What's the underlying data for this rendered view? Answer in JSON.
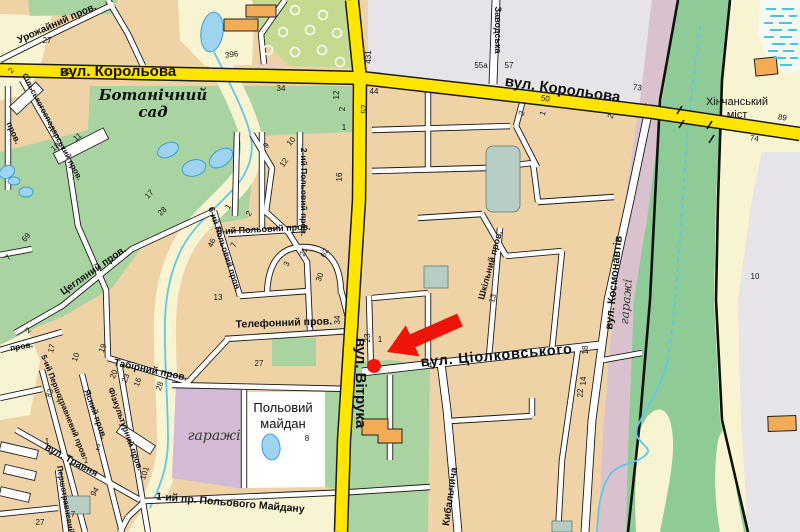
{
  "map": {
    "palette": {
      "main_road_yellow": "#FFE500",
      "road_casing_black": "#1B1B1B",
      "minor_road_white": "#FFFFFF",
      "city_block_tan": "#EFD3A6",
      "field_cream": "#F8F4D2",
      "park_green": "#A9D3A0",
      "orchard_green": "#C3DA90",
      "valley_green": "#8FCB96",
      "railway_band_mauve": "#D9C2CE",
      "garage_block_mauve": "#D5BAD6",
      "urban_grey": "#E6E4E9",
      "water_blue": "#9FD4F0",
      "stream_blue": "#5FC8E6",
      "reservoir_teal": "#B5CDC4",
      "building_orange": "#F2AC55",
      "marker_red": "#EE1408"
    },
    "marker": {
      "type": "arrow-and-dot",
      "color": "#EE1408"
    },
    "street_labels": [
      {
        "t": "вул. Корольова",
        "x": 118,
        "y": 76,
        "r": 0,
        "c": "s-big",
        "n": "street-korolova-west"
      },
      {
        "t": "вул. Корольова",
        "x": 562,
        "y": 94,
        "r": 8,
        "c": "s-big",
        "n": "street-korolova-east"
      },
      {
        "t": "вул. Вітрука",
        "x": 356,
        "y": 383,
        "r": 90,
        "c": "s-big",
        "n": "street-vitruka"
      },
      {
        "t": "вул. Ціолковського",
        "x": 497,
        "y": 360,
        "r": -5,
        "c": "s-ciol",
        "n": "street-tsiolkovskogo"
      },
      {
        "t": "вул. Космонавтів",
        "x": 617,
        "y": 283,
        "r": -84,
        "c": "s-med",
        "n": "street-kosmonavtiv"
      },
      {
        "t": "Ботанічний",
        "x": 153,
        "y": 100,
        "r": 0,
        "c": "s-serif",
        "n": "area-botanical-garden-line1"
      },
      {
        "t": "сад",
        "x": 153,
        "y": 117,
        "r": 0,
        "c": "s-serif",
        "n": "area-botanical-garden-line2"
      },
      {
        "t": "Хінчанський",
        "x": 737,
        "y": 105,
        "r": 0,
        "c": "s-plain11",
        "n": "bridge-khinchanskyi-line1"
      },
      {
        "t": "міст",
        "x": 737,
        "y": 118,
        "r": 0,
        "c": "s-plain11",
        "n": "bridge-khinchanskyi-line2"
      },
      {
        "t": "гаражі",
        "x": 630,
        "y": 302,
        "r": -85,
        "c": "s-serifg",
        "n": "area-garages-east"
      },
      {
        "t": "гаражі",
        "x": 214,
        "y": 440,
        "r": 0,
        "c": "s-serifg14",
        "n": "area-garages-south"
      },
      {
        "t": "Польовий",
        "x": 283,
        "y": 412,
        "r": 0,
        "c": "s-plain",
        "n": "area-polovyi-maidan-line1"
      },
      {
        "t": "майдан",
        "x": 283,
        "y": 428,
        "r": 0,
        "c": "s-plain",
        "n": "area-polovyi-maidan-line2"
      },
      {
        "t": "Урожайний пров.",
        "x": 58,
        "y": 26,
        "r": -24,
        "c": "s-lane",
        "n": "lane-urozhainyi"
      },
      {
        "t": "Сільськогосподарський пров.",
        "x": 50,
        "y": 128,
        "r": 62,
        "c": "s-lane8",
        "n": "lane-silskohospodarskyi"
      },
      {
        "t": "Цегляний пров.",
        "x": 95,
        "y": 273,
        "r": -35,
        "c": "s-lane",
        "n": "lane-tsehlianyi"
      },
      {
        "t": "Телефонний пров.",
        "x": 284,
        "y": 326,
        "r": -2,
        "c": "s-lane105",
        "n": "lane-telefonnyi"
      },
      {
        "t": "Табірний пров.",
        "x": 150,
        "y": 373,
        "r": 12,
        "c": "s-lane",
        "n": "lane-tabirnyi"
      },
      {
        "t": "5-ий Польовий пров.",
        "x": 264,
        "y": 232,
        "r": -3,
        "c": "s-lane9",
        "n": "lane-polovyi-5"
      },
      {
        "t": "2-ий Польовий пров.",
        "x": 301,
        "y": 192,
        "r": 90,
        "c": "s-lane85",
        "n": "lane-polovyi-2"
      },
      {
        "t": "6-ий Польовий пров.",
        "x": 222,
        "y": 250,
        "r": 72,
        "c": "s-lane85",
        "n": "lane-polovyi-6"
      },
      {
        "t": "5-ий Першотравневий пров.",
        "x": 62,
        "y": 408,
        "r": 68,
        "c": "s-lane8",
        "n": "lane-pershotravnevyi-5"
      },
      {
        "t": "Ясний пров.",
        "x": 93,
        "y": 415,
        "r": 70,
        "c": "s-lane85",
        "n": "lane-yasnyi"
      },
      {
        "t": "Фізкультурний пров.",
        "x": 123,
        "y": 430,
        "r": 70,
        "c": "s-lane85",
        "n": "lane-fizkulturnyi"
      },
      {
        "t": "вул. Травня",
        "x": 70,
        "y": 463,
        "r": 28,
        "c": "s-lane",
        "n": "street-travnia"
      },
      {
        "t": "Першотравневий",
        "x": 63,
        "y": 500,
        "r": 80,
        "c": "s-lane8",
        "n": "lane-pershotravnevyi"
      },
      {
        "t": "1-ий пр. Польового Майдану",
        "x": 230,
        "y": 506,
        "r": 5,
        "c": "s-lane105",
        "n": "lane-pr-polovogo-maidanu"
      },
      {
        "t": "Шкільний пров.",
        "x": 493,
        "y": 266,
        "r": -75,
        "c": "s-lane9",
        "n": "lane-shkilnyi"
      },
      {
        "t": "Кибальчича",
        "x": 453,
        "y": 497,
        "r": -82,
        "c": "s-lane",
        "n": "street-kybalchycha"
      },
      {
        "t": "Заводська",
        "x": 495,
        "y": 30,
        "r": 90,
        "c": "s-lane9",
        "n": "street-zavodska"
      },
      {
        "t": "пров.",
        "x": 11,
        "y": 134,
        "r": 65,
        "c": "s-lane85",
        "n": "lane-left-edge"
      },
      {
        "t": "пров.",
        "x": 22,
        "y": 349,
        "r": -10,
        "c": "s-lane85",
        "n": "lane-left-edge-2"
      }
    ],
    "house_numbers": [
      {
        "t": "27",
        "x": 47,
        "y": 43
      },
      {
        "t": "396",
        "x": 232,
        "y": 57,
        "r": -8
      },
      {
        "t": "2",
        "x": 13,
        "y": 72,
        "r": -50
      },
      {
        "t": "32",
        "x": 67,
        "y": 74
      },
      {
        "t": "34",
        "x": 281,
        "y": 91
      },
      {
        "t": "12",
        "x": 339,
        "y": 95,
        "r": -90
      },
      {
        "t": "2",
        "x": 345,
        "y": 109,
        "r": -90
      },
      {
        "t": "1",
        "x": 344,
        "y": 130
      },
      {
        "t": "44",
        "x": 374,
        "y": 94
      },
      {
        "t": "52",
        "x": 367,
        "y": 109,
        "r": -90
      },
      {
        "t": "431",
        "x": 371,
        "y": 57,
        "r": -90
      },
      {
        "t": "55а",
        "x": 481,
        "y": 68
      },
      {
        "t": "57",
        "x": 509,
        "y": 68
      },
      {
        "t": "73",
        "x": 637,
        "y": 90,
        "r": 8
      },
      {
        "t": "50",
        "x": 545,
        "y": 101,
        "r": 8
      },
      {
        "t": "2",
        "x": 524,
        "y": 114,
        "r": -70
      },
      {
        "t": "1",
        "x": 545,
        "y": 114,
        "r": -70
      },
      {
        "t": "2",
        "x": 613,
        "y": 117,
        "r": -70
      },
      {
        "t": "89",
        "x": 782,
        "y": 120,
        "r": 8
      },
      {
        "t": "74",
        "x": 754,
        "y": 141,
        "r": 8
      },
      {
        "t": "10",
        "x": 755,
        "y": 279
      },
      {
        "t": "18",
        "x": 57,
        "y": 149,
        "r": -40
      },
      {
        "t": "11",
        "x": 79,
        "y": 139,
        "r": -40
      },
      {
        "t": "9",
        "x": 268,
        "y": 147,
        "r": -50
      },
      {
        "t": "10",
        "x": 293,
        "y": 143,
        "r": -50
      },
      {
        "t": "12",
        "x": 286,
        "y": 164,
        "r": -55
      },
      {
        "t": "16",
        "x": 342,
        "y": 177,
        "r": -90
      },
      {
        "t": "17",
        "x": 151,
        "y": 196,
        "r": -45
      },
      {
        "t": "28",
        "x": 164,
        "y": 213,
        "r": -45
      },
      {
        "t": "1",
        "x": 230,
        "y": 208,
        "r": -55
      },
      {
        "t": "2",
        "x": 251,
        "y": 215,
        "r": -55
      },
      {
        "t": "46",
        "x": 214,
        "y": 244,
        "r": -65
      },
      {
        "t": "7",
        "x": 236,
        "y": 246,
        "r": -65
      },
      {
        "t": "21",
        "x": 306,
        "y": 253,
        "r": -65
      },
      {
        "t": "62",
        "x": 327,
        "y": 254,
        "r": -65
      },
      {
        "t": "3",
        "x": 289,
        "y": 265,
        "r": -65
      },
      {
        "t": "69",
        "x": 28,
        "y": 239,
        "r": -50
      },
      {
        "t": "7",
        "x": 10,
        "y": 259,
        "r": -50
      },
      {
        "t": "2",
        "x": 30,
        "y": 332,
        "r": -45
      },
      {
        "t": "17",
        "x": 54,
        "y": 349,
        "r": -75
      },
      {
        "t": "10",
        "x": 78,
        "y": 358,
        "r": -70
      },
      {
        "t": "19",
        "x": 105,
        "y": 349,
        "r": -70
      },
      {
        "t": "20",
        "x": 116,
        "y": 375,
        "r": -70
      },
      {
        "t": "23",
        "x": 128,
        "y": 379,
        "r": -70
      },
      {
        "t": "16",
        "x": 140,
        "y": 383,
        "r": -70
      },
      {
        "t": "28",
        "x": 162,
        "y": 387,
        "r": -70
      },
      {
        "t": "13",
        "x": 218,
        "y": 300
      },
      {
        "t": "30",
        "x": 322,
        "y": 278,
        "r": -70
      },
      {
        "t": "34",
        "x": 340,
        "y": 320,
        "r": -90
      },
      {
        "t": "23",
        "x": 370,
        "y": 338,
        "r": -90
      },
      {
        "t": "1",
        "x": 380,
        "y": 342
      },
      {
        "t": "27",
        "x": 259,
        "y": 366
      },
      {
        "t": "13",
        "x": 495,
        "y": 299,
        "r": -75
      },
      {
        "t": "4",
        "x": 430,
        "y": 368
      },
      {
        "t": "18",
        "x": 588,
        "y": 350,
        "r": -90
      },
      {
        "t": "14",
        "x": 586,
        "y": 381,
        "r": -90
      },
      {
        "t": "22",
        "x": 583,
        "y": 393,
        "r": -90
      },
      {
        "t": "83",
        "x": 52,
        "y": 394,
        "r": -70
      },
      {
        "t": "1",
        "x": 58,
        "y": 402
      },
      {
        "t": "1",
        "x": 47,
        "y": 444
      },
      {
        "t": "2",
        "x": 98,
        "y": 450
      },
      {
        "t": "1",
        "x": 86,
        "y": 463
      },
      {
        "t": "101",
        "x": 147,
        "y": 474,
        "r": -70
      },
      {
        "t": "94",
        "x": 97,
        "y": 493,
        "r": -60
      },
      {
        "t": "27",
        "x": 40,
        "y": 525
      },
      {
        "t": "7",
        "x": 73,
        "y": 517
      },
      {
        "t": "8",
        "x": 307,
        "y": 441
      }
    ]
  }
}
